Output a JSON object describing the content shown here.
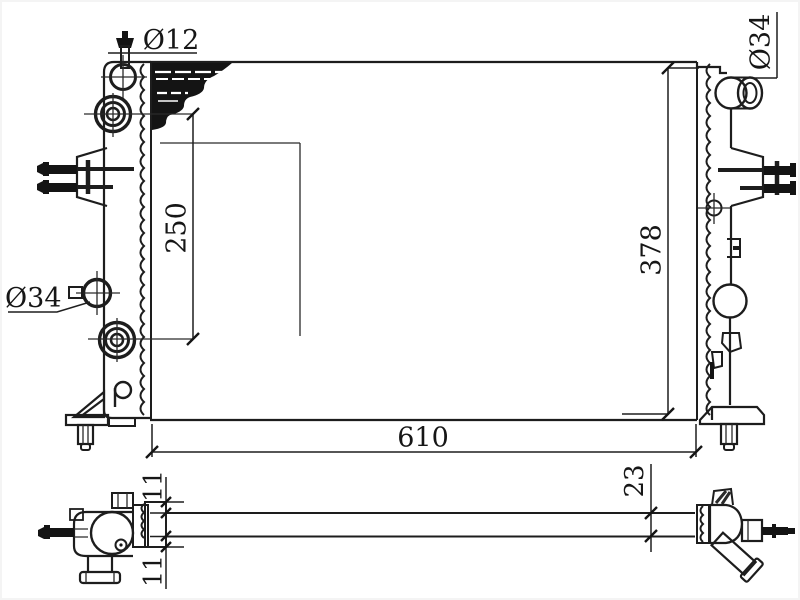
{
  "page": {
    "background": "#ffffff",
    "line_color": "#1d1d1d"
  },
  "drawing": {
    "type": "radiator-engineering-drawing",
    "dimensions": {
      "top_left_port_diameter": "Ø12",
      "left_port_diameter": "Ø34",
      "right_port_diameter": "Ø34",
      "left_port_spacing": "250",
      "overall_height": "378",
      "overall_width": "610",
      "top_overhang": "11",
      "bottom_overhang": "11",
      "core_depth": "23"
    }
  }
}
